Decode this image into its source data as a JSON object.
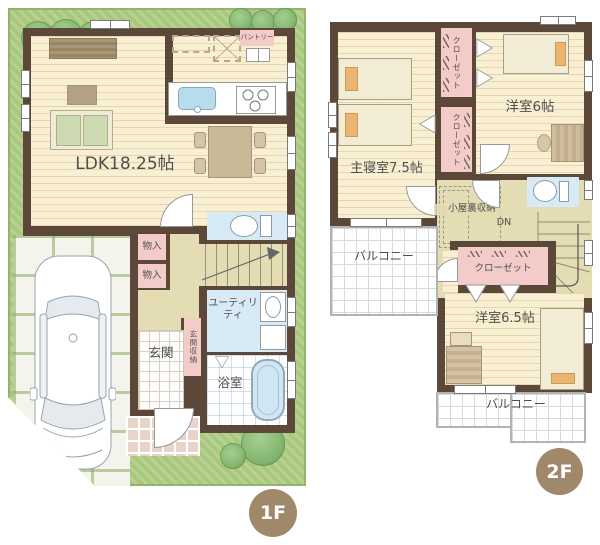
{
  "floor1": {
    "badge": "1F",
    "ldk_label": "LDK18.25帖",
    "pantry_label": "パントリー",
    "storage_upper_label": "物入",
    "storage_lower_label": "物入",
    "stairs_label": "UP",
    "utility_label": "ユーティリティ",
    "genkan_label": "玄関",
    "genkan_storage_label": "玄関収納",
    "bath_label": "浴室"
  },
  "floor2": {
    "badge": "2F",
    "master_label": "主寝室7.5帖",
    "closet_a_label": "クローゼット",
    "closet_b_label": "クローゼット",
    "closet_c_label": "クローゼット",
    "room6_label": "洋室6帖",
    "attic_label": "小屋裏収納",
    "stairs_label": "DN",
    "room65_label": "洋室6.5帖",
    "balcony_master_label": "バルコニー",
    "balcony_south_label": "バルコニー"
  },
  "colors": {
    "wall": "#5b4839",
    "lawn": "#a9c87e",
    "wood_floor": "#f9efd3",
    "hall_floor": "#e4dcb2",
    "closet_pink": "#f3cbc8",
    "water_blue": "#d8eaf5",
    "badge_brown": "#a0886b",
    "tree_green": "#87b973",
    "balcony_rail": "#b3b3b3"
  }
}
